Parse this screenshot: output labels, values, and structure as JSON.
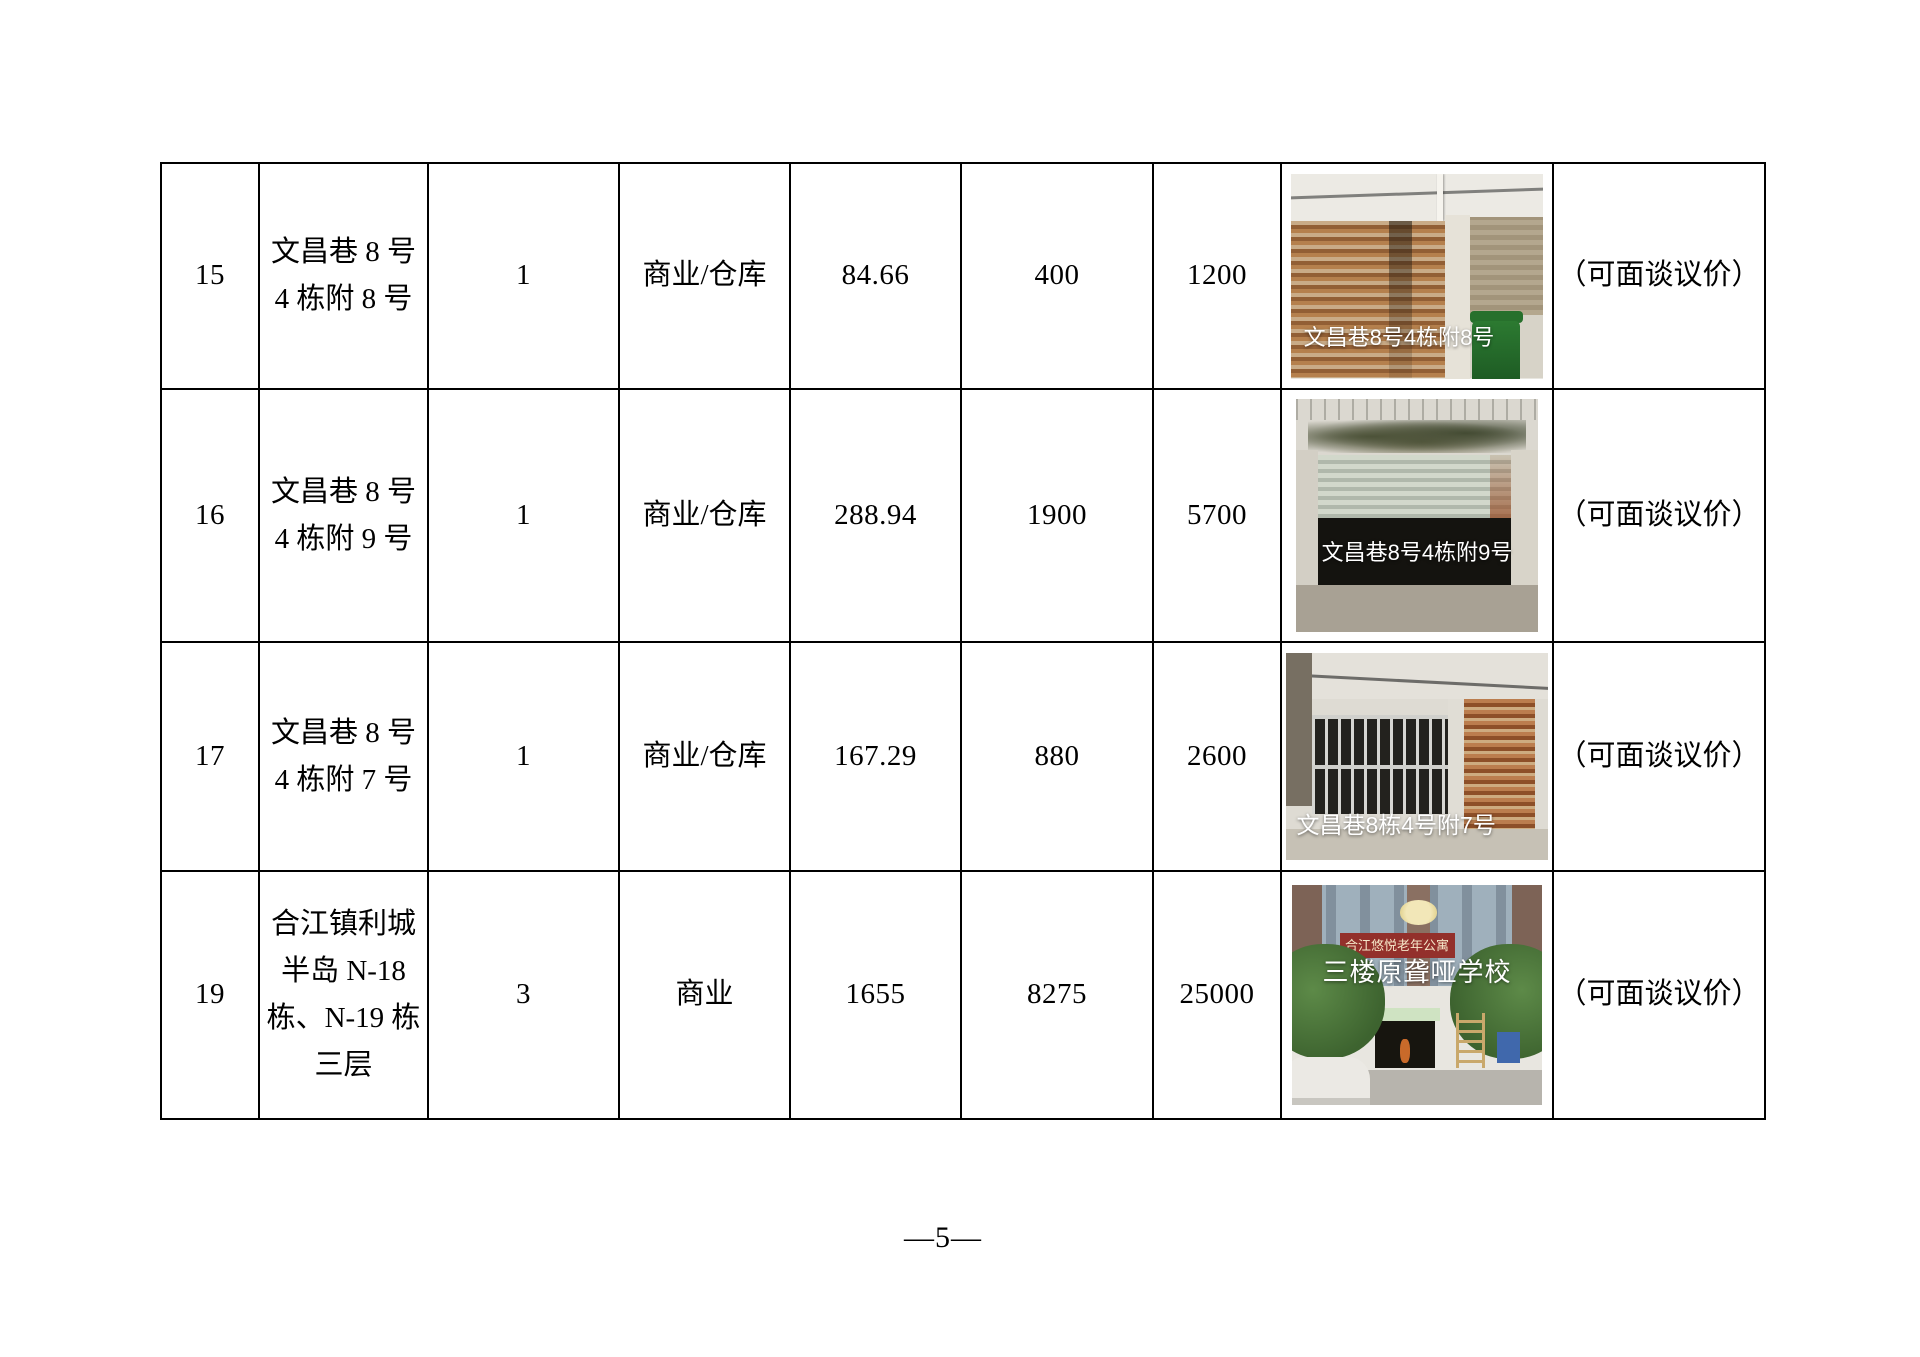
{
  "footer": {
    "page_number": "—5—"
  },
  "table": {
    "rows": [
      {
        "no": "15",
        "address_lines": [
          "文昌巷 8 号",
          "4 栋附 8 号"
        ],
        "count": "1",
        "usage_type": "商业/仓库",
        "area": "84.66",
        "price_a": "400",
        "price_b": "1200",
        "photo_caption": "文昌巷8号4栋附8号",
        "note": "（可面谈议价）"
      },
      {
        "no": "16",
        "address_lines": [
          "文昌巷 8 号",
          "4 栋附 9 号"
        ],
        "count": "1",
        "usage_type": "商业/仓库",
        "area": "288.94",
        "price_a": "1900",
        "price_b": "5700",
        "photo_caption": "文昌巷8号4栋附9号",
        "note": "（可面谈议价）"
      },
      {
        "no": "17",
        "address_lines": [
          "文昌巷 8 号",
          "4 栋附 7 号"
        ],
        "count": "1",
        "usage_type": "商业/仓库",
        "area": "167.29",
        "price_a": "880",
        "price_b": "2600",
        "photo_caption": "文昌巷8栋4号附7号",
        "note": "（可面谈议价）"
      },
      {
        "no": "19",
        "address_lines": [
          "合江镇利城",
          "半岛 N-18",
          "栋、N-19 栋",
          "三层"
        ],
        "count": "3",
        "usage_type": "商业",
        "area": "1655",
        "price_a": "8275",
        "price_b": "25000",
        "photo_banner_text": "合江悠悦老年公寓",
        "photo_caption": "三楼原聋哑学校",
        "note": "（可面谈议价）"
      }
    ]
  }
}
